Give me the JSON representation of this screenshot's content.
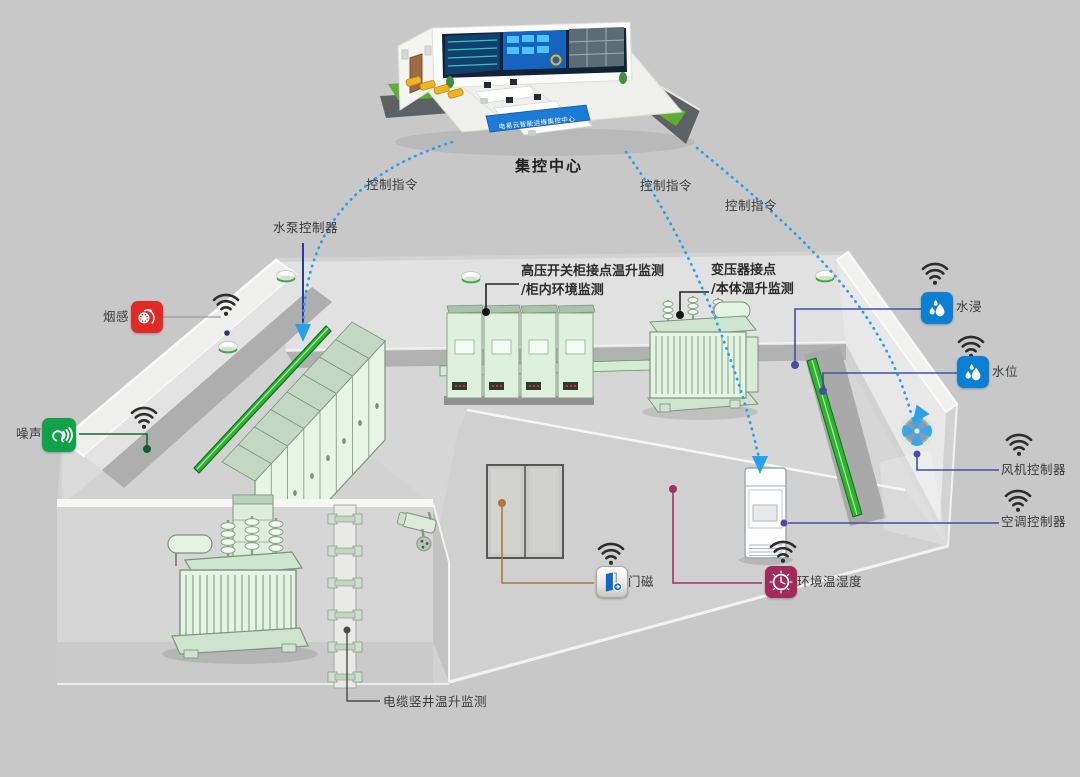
{
  "control_center": {
    "label": "集控中心",
    "banner": "电易云智能运维集控中心"
  },
  "commands": [
    {
      "label": "控制指令"
    },
    {
      "label": "控制指令"
    },
    {
      "label": "控制指令"
    }
  ],
  "annotations": {
    "pump_controller": {
      "label": "水泵控制器"
    },
    "smoke": {
      "label": "烟感"
    },
    "noise": {
      "label": "噪声"
    },
    "switchgear": {
      "line1": "高压开关柜接点温升监测",
      "line2": "/柜内环境监测"
    },
    "transformer": {
      "line1": "变压器接点",
      "line2": "/本体温升监测"
    },
    "flood": {
      "label": "水浸"
    },
    "water_level": {
      "label": "水位"
    },
    "fan_controller": {
      "label": "风机控制器"
    },
    "ac_controller": {
      "label": "空调控制器"
    },
    "door_magnet": {
      "label": "门磁"
    },
    "env_temp_humidity": {
      "label": "环境温湿度"
    },
    "cable_shaft": {
      "label": "电缆竖井温升监测"
    }
  },
  "colors": {
    "background": "#c8c8c8",
    "dashed_command": "#2aa0e8",
    "smoke_tile": "#e12a26",
    "noise_tile": "#11a14b",
    "water_tile": "#0b7fd4",
    "env_tile": "#a12a58",
    "door_glyph": "#1069c9",
    "connector_indigo": "#4a4aa6",
    "connector_orange": "#b5762e",
    "connector_crimson": "#a63066",
    "connector_navy": "#2c3c9c",
    "connector_green": "#0d5e2f",
    "duct_green": "#2fb42f"
  }
}
